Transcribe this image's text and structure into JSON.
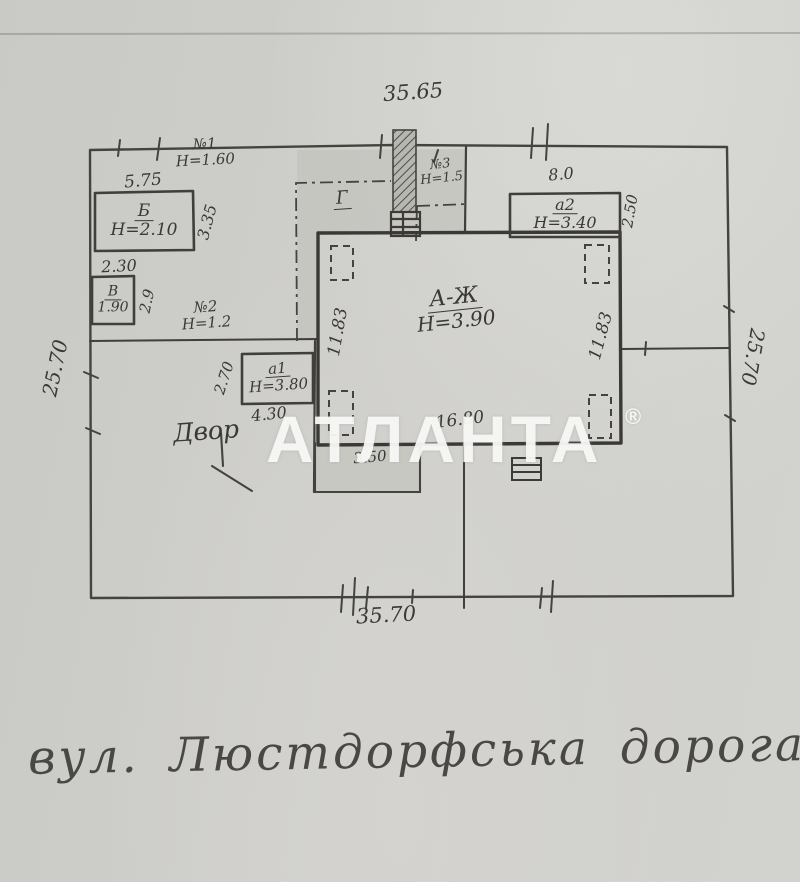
{
  "watermark": {
    "text": "АТЛАНТА",
    "registered_mark": "®"
  },
  "street_caption": "вул. Люстдорфська дорога",
  "plot_dimensions": {
    "top": "35.65",
    "bottom": "35.70",
    "left": "25.70",
    "right": "25.70"
  },
  "main_building": {
    "label": "А-Ж",
    "height": "Н=3.90",
    "left_side": "11.83",
    "right_side": "11.83",
    "bottom_side": "16.80"
  },
  "annex_a1": {
    "label": "а1",
    "height": "Н=3.80",
    "depth": "2.70",
    "width": "4.30"
  },
  "annex_a2": {
    "label": "а2",
    "height": "Н=3.40",
    "width": "8.0",
    "depth": "2.50"
  },
  "shed_b": {
    "label": "Б",
    "height": "Н=2.10",
    "width": "5.75",
    "depth": "3.35",
    "gap_below": "2.30"
  },
  "shed_v": {
    "label": "В",
    "size": "1.90",
    "depth": "2.9"
  },
  "structure_n1": {
    "label": "№1",
    "height": "Н=1.60"
  },
  "structure_n2": {
    "label": "№2",
    "height": "Н=1.2"
  },
  "structure_n3": {
    "label": "№3",
    "height": "Н=1.5"
  },
  "veranda_g": {
    "label": "Г"
  },
  "porch": {
    "width": "3.50"
  },
  "yard": {
    "label": "Двор"
  }
}
